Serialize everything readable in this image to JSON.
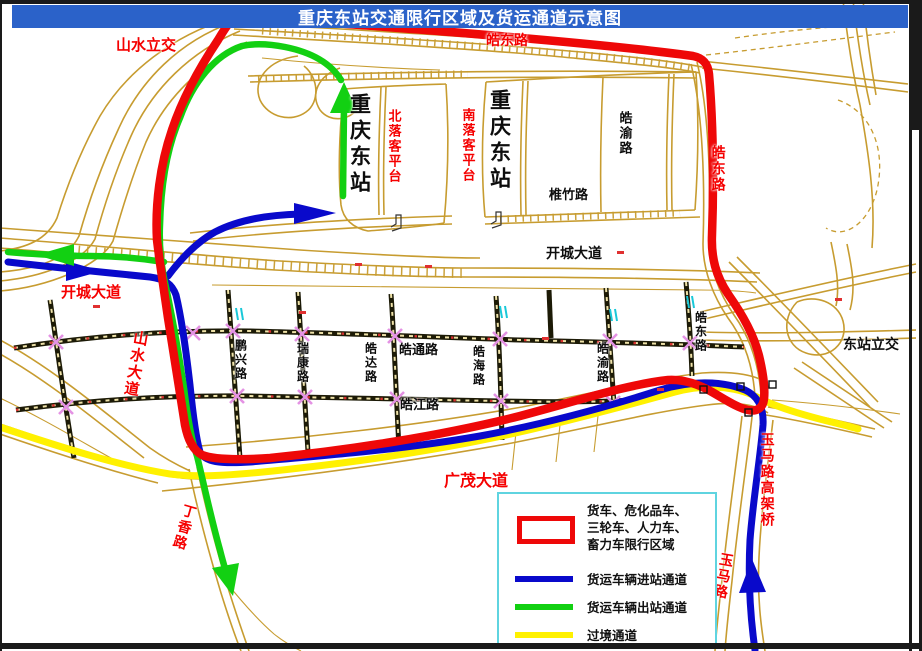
{
  "title": "重庆东站交通限行区域及货运通道示意图",
  "colors": {
    "titlebar": "#2b62c9",
    "road": "#c79c30",
    "restricted": "#ee0808",
    "inbound": "#0909cb",
    "outbound": "#12d012",
    "transit": "#fff100"
  },
  "map_labels": [
    {
      "id": "shanshui-interchange",
      "text": "山水立交",
      "color": "red",
      "o": "h",
      "x": 116,
      "y": 37,
      "s": 15
    },
    {
      "id": "haodong-road-top",
      "text": "皓东路",
      "color": "red",
      "o": "h",
      "x": 486,
      "y": 34,
      "s": 14
    },
    {
      "id": "haodong-road-right",
      "text": "皓东路",
      "color": "red",
      "o": "v",
      "x": 709,
      "y": 145,
      "s": 14
    },
    {
      "id": "station-name-west",
      "text": "重庆东站",
      "color": "black",
      "o": "v",
      "x": 347,
      "y": 93,
      "s": 21,
      "big": true
    },
    {
      "id": "north-platform",
      "text": "北落客平台",
      "color": "red",
      "o": "v",
      "x": 385,
      "y": 109,
      "s": 13
    },
    {
      "id": "station-name-east",
      "text": "重庆东站",
      "color": "black",
      "o": "v",
      "x": 487,
      "y": 89,
      "s": 21,
      "big": true
    },
    {
      "id": "south-platform",
      "text": "南落客平台",
      "color": "red",
      "o": "v",
      "x": 459,
      "y": 108,
      "s": 13
    },
    {
      "id": "haoyu-road-north",
      "text": "皓渝路",
      "color": "black",
      "o": "v",
      "x": 616,
      "y": 111,
      "s": 13
    },
    {
      "id": "qiaozhu-road",
      "text": "椎竹路",
      "color": "black",
      "o": "h",
      "x": 549,
      "y": 189,
      "s": 13
    },
    {
      "id": "kaicheng-avenue-east",
      "text": "开城大道",
      "color": "black",
      "o": "h",
      "x": 546,
      "y": 247,
      "s": 14
    },
    {
      "id": "kaicheng-avenue-west",
      "text": "开城大道",
      "color": "red",
      "o": "h",
      "x": 61,
      "y": 284,
      "s": 15
    },
    {
      "id": "shanshui-avenue",
      "text": "山水大道",
      "color": "red",
      "o": "v",
      "x": 127,
      "y": 330,
      "s": 15,
      "rot": 10
    },
    {
      "id": "pengxing-road",
      "text": "鹏兴路",
      "color": "black",
      "o": "v",
      "x": 233,
      "y": 339,
      "s": 12
    },
    {
      "id": "ruikang-road",
      "text": "瑞康路",
      "color": "black",
      "o": "v",
      "x": 295,
      "y": 342,
      "s": 12
    },
    {
      "id": "haoda-road",
      "text": "皓达路",
      "color": "black",
      "o": "v",
      "x": 363,
      "y": 342,
      "s": 12
    },
    {
      "id": "haotong-road",
      "text": "皓通路",
      "color": "black",
      "o": "h",
      "x": 399,
      "y": 344,
      "s": 13
    },
    {
      "id": "haohai-road",
      "text": "皓海路",
      "color": "black",
      "o": "v",
      "x": 471,
      "y": 345,
      "s": 12
    },
    {
      "id": "haojiang-road",
      "text": "皓江路",
      "color": "black",
      "o": "h",
      "x": 400,
      "y": 399,
      "s": 13
    },
    {
      "id": "haoyu-road-grid",
      "text": "皓渝路",
      "color": "black",
      "o": "v",
      "x": 595,
      "y": 342,
      "s": 12
    },
    {
      "id": "haodong-road-grid",
      "text": "皓东路",
      "color": "black",
      "o": "v",
      "x": 693,
      "y": 311,
      "s": 12
    },
    {
      "id": "dongzhan-interchange",
      "text": "东站立交",
      "color": "black",
      "o": "h",
      "x": 843,
      "y": 338,
      "s": 14
    },
    {
      "id": "guangmao-avenue",
      "text": "广茂大道",
      "color": "red",
      "o": "h",
      "x": 444,
      "y": 472,
      "s": 16
    },
    {
      "id": "dingxiang-road",
      "text": "丁香路",
      "color": "red",
      "o": "v",
      "x": 175,
      "y": 503,
      "s": 14,
      "rot": 16
    },
    {
      "id": "yuma-viaduct",
      "text": "玉马路高架桥",
      "color": "red",
      "o": "v",
      "x": 758,
      "y": 432,
      "s": 14
    },
    {
      "id": "yuma-road",
      "text": "玉马路",
      "color": "red",
      "o": "v",
      "x": 714,
      "y": 552,
      "s": 14,
      "rot": 10
    }
  ],
  "legend": {
    "restricted_lines": [
      "货车、危化品车、",
      "三轮车、人力车、",
      "畜力车限行区域"
    ],
    "items": [
      {
        "id": "inbound",
        "label": "货运车辆进站通道"
      },
      {
        "id": "outbound",
        "label": "货运车辆出站通道"
      },
      {
        "id": "transit",
        "label": "过境通道"
      }
    ]
  }
}
